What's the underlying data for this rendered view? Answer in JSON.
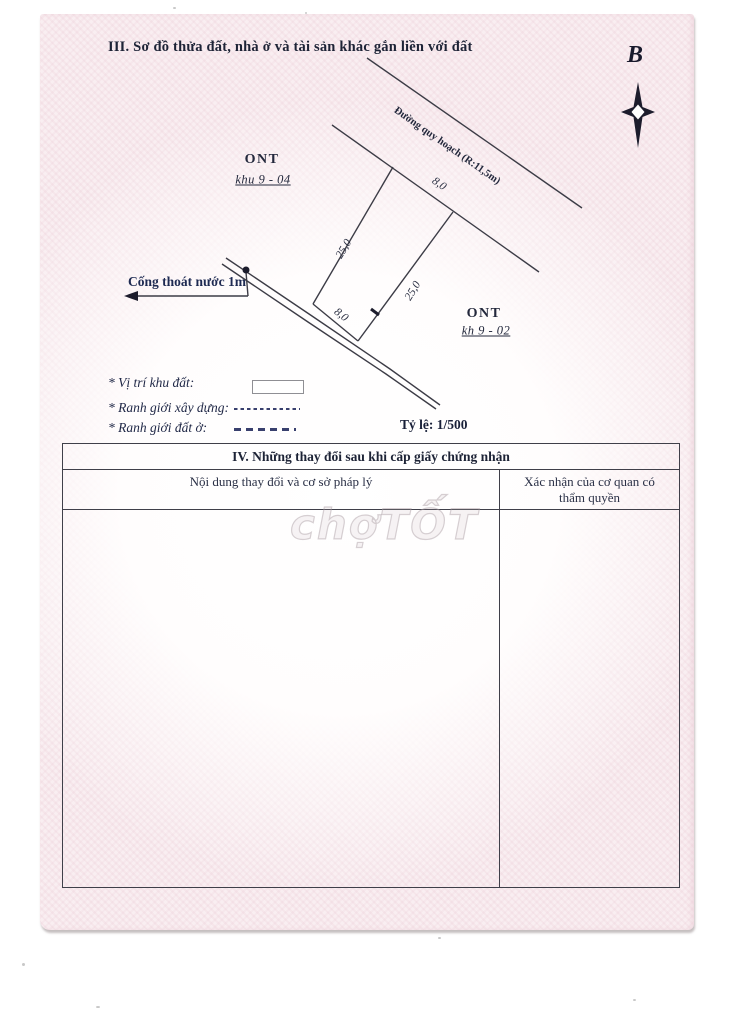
{
  "page": {
    "section3_title": "III. Sơ đồ thửa đất, nhà ở và tài sản khác gắn liền với đất"
  },
  "compass": {
    "north_label": "B",
    "icon": "four-point-compass-star"
  },
  "diagram": {
    "road_label": "Đường quy hoạch (R:11,5m)",
    "drain_label": "Cống thoát nước 1m",
    "zone_left": {
      "name": "ONT",
      "code": "khu 9 - 04"
    },
    "zone_right": {
      "name": "ONT",
      "code": "kh 9 - 02"
    },
    "dims": {
      "front": "8,0",
      "left": "25,0",
      "right": "25,0",
      "back": "8,0"
    }
  },
  "legend": {
    "items": [
      {
        "label": "* Vị trí khu đất:",
        "swatch": "empty-rectangle"
      },
      {
        "label": "* Ranh giới xây dựng:",
        "swatch": "fine-dashed-line"
      },
      {
        "label": "* Ranh giới đất ở:",
        "swatch": "wide-dashed-line"
      }
    ],
    "scale": "Tỷ lệ: 1/500"
  },
  "table": {
    "title": "IV. Những thay đổi sau khi cấp giấy chứng nhận",
    "columns": [
      "Nội dung thay đổi và cơ sở pháp lý",
      "Xác nhận của cơ quan có thẩm quyền"
    ]
  },
  "watermark": "chợTỐT",
  "colors": {
    "ink": "#20263a",
    "navy_ink": "#1e2a52",
    "sketch_line": "#3c3c46",
    "paper_pink": "#f9eef1",
    "watermark_gray": "#c9bcc2"
  }
}
